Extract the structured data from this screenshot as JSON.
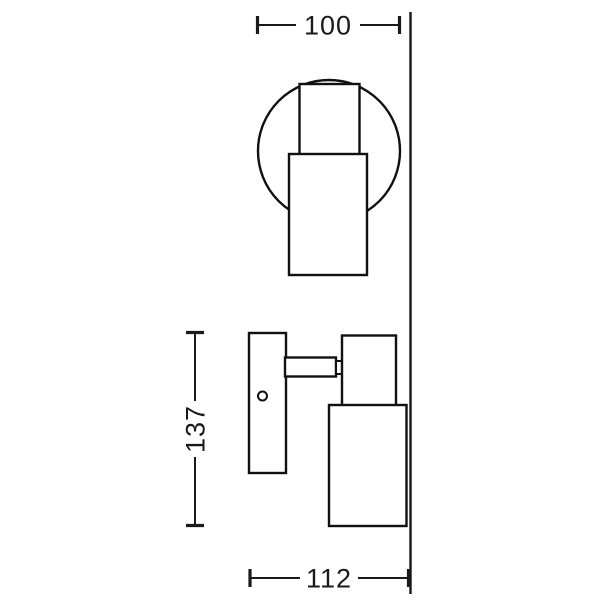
{
  "drawing": {
    "type": "technical-dimension-drawing",
    "subject": "wall spotlight fixture, front view and side view",
    "colors": {
      "line": "#1a1a1a",
      "background": "#ffffff"
    },
    "dimensions": {
      "top_width": {
        "label": "100"
      },
      "side_height": {
        "label": "137"
      },
      "bottom_depth": {
        "label": "112"
      }
    }
  }
}
